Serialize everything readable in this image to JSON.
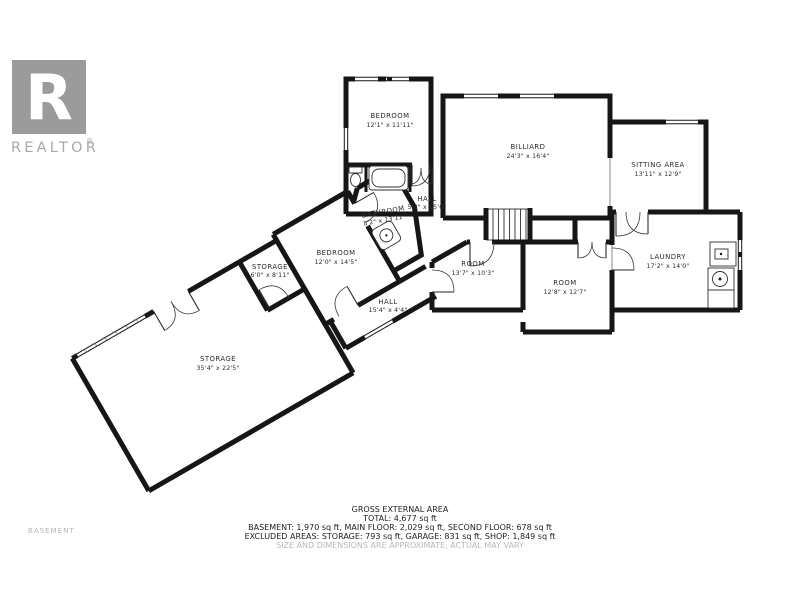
{
  "branding": {
    "logo_letter": "R",
    "logo_text": "REALTOR",
    "registered_mark": "®"
  },
  "floor_label": "BASEMENT",
  "rooms": [
    {
      "name": "BEDROOM",
      "dims": "12'1\" x 11'11\""
    },
    {
      "name": "BILLIARD",
      "dims": "24'3\" x 16'4\""
    },
    {
      "name": "SITTING AREA",
      "dims": "13'11\" x 12'9\""
    },
    {
      "name": "HALL",
      "dims": "5'8\" x 15'0\""
    },
    {
      "name": "BATHROOM",
      "dims": "8'2\" x 13'11\""
    },
    {
      "name": "BEDROOM",
      "dims": "12'0\" x 14'5\""
    },
    {
      "name": "STORAGE",
      "dims": "6'0\" x 8'11\""
    },
    {
      "name": "HALL",
      "dims": "15'4\" x 4'4\""
    },
    {
      "name": "ROOM",
      "dims": "13'7\" x 10'3\""
    },
    {
      "name": "ROOM",
      "dims": "12'8\" x 12'7\""
    },
    {
      "name": "LAUNDRY",
      "dims": "17'2\" x 14'0\""
    },
    {
      "name": "STORAGE",
      "dims": "35'4\" x 22'5\""
    }
  ],
  "summary": {
    "title": "GROSS EXTERNAL AREA",
    "total": "TOTAL: 4,677 sq ft",
    "floors": "BASEMENT: 1,970 sq ft, MAIN FLOOR: 2,029 sq ft, SECOND FLOOR: 678 sq ft",
    "excluded": "EXCLUDED AREAS: STORAGE: 793 sq ft, GARAGE: 831 sq ft, SHOP: 1,849 sq ft",
    "disclaimer": "SIZE AND DIMENSIONS ARE APPROXIMATE, ACTUAL MAY VARY"
  },
  "colors": {
    "wall": "#161616",
    "logo_box": "#9b9b9b",
    "logo_text": "#a9a9a9",
    "label_text": "#2b2b2b",
    "muted_text": "#b9b9b9"
  }
}
